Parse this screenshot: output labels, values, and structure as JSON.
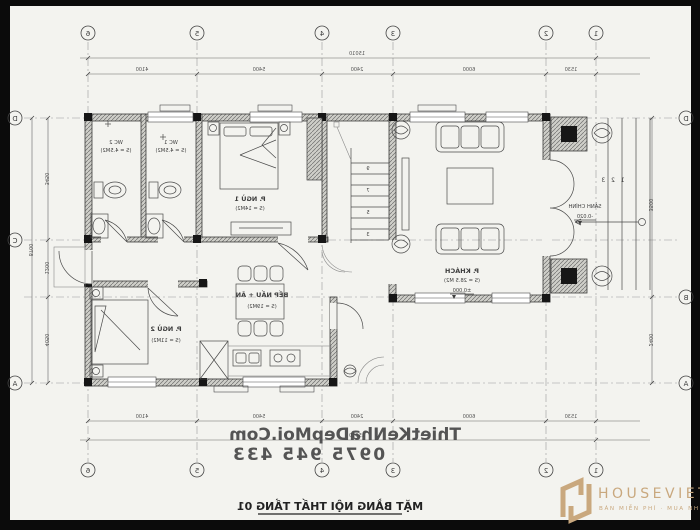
{
  "document": {
    "title": "MẶT BẰNG NỘI THẤT TẦNG 01",
    "watermark_line1": "ThietKeNhaDepMoi.Com",
    "watermark_line2": "0975 945 433"
  },
  "logo": {
    "name": "HOUSEVIET",
    "tagline": "BÁN MIỄN PHÍ · MUA NHƯ Ý",
    "color": "#c9a87e"
  },
  "grid": {
    "cols": [
      "6",
      "5",
      "4",
      "3",
      "2",
      "1"
    ],
    "rows": [
      "D",
      "C",
      "B",
      "A"
    ]
  },
  "rooms": {
    "wc2": {
      "name": "WC 2",
      "area": "(S = 4.5M2)"
    },
    "wc1": {
      "name": "WC 1",
      "area": "(S = 4.5M2)"
    },
    "bed1": {
      "name": "P. NGỦ 1",
      "area": "(S = 14M2)"
    },
    "living": {
      "name": "P. KHÁCH",
      "area": "(S = 28.5 M2)",
      "elevation": "±0.000"
    },
    "bed2": {
      "name": "P. NGỦ 2",
      "area": "(S = 11M2)"
    },
    "kitchen": {
      "name": "BẾP NẤU + ĂN",
      "area": "(S = 19M2)"
    },
    "porch": {
      "name": "SẢNH CHÍNH",
      "elevation": "-0.020",
      "steps": "1 2 3"
    }
  },
  "stairs": {
    "treads": [
      "9",
      "7",
      "5",
      "3"
    ]
  },
  "dims": {
    "top_overall": "15010",
    "top_segments": [
      "4100",
      "5400",
      "2400",
      "6000",
      "1530"
    ],
    "bottom_segments": [
      "4100",
      "5400",
      "2400",
      "6000",
      "1530"
    ],
    "bottom_overall": "15010",
    "left_segments": [
      "3450",
      "1200",
      "4050"
    ],
    "left_overall": "8700",
    "right_segments": [
      "3500",
      "2400"
    ]
  },
  "colors": {
    "ink": "#3d3d3d",
    "accent": "#c9a87e",
    "paper": "#f3f3ef"
  }
}
